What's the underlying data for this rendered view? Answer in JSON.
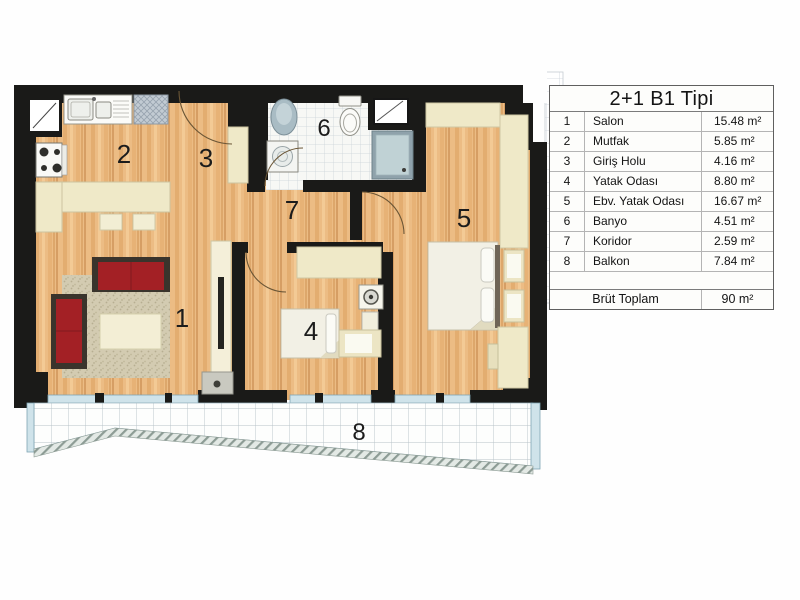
{
  "legend": {
    "title": "2+1 B1 Tipi",
    "rows": [
      {
        "num": "1",
        "name": "Salon",
        "area": "15.48 m²"
      },
      {
        "num": "2",
        "name": "Mutfak",
        "area": "5.85 m²"
      },
      {
        "num": "3",
        "name": "Giriş Holu",
        "area": "4.16 m²"
      },
      {
        "num": "4",
        "name": "Yatak Odası",
        "area": "8.80 m²"
      },
      {
        "num": "5",
        "name": "Ebv. Yatak Odası",
        "area": "16.67 m²"
      },
      {
        "num": "6",
        "name": "Banyo",
        "area": "4.51 m²"
      },
      {
        "num": "7",
        "name": "Koridor",
        "area": "2.59 m²"
      },
      {
        "num": "8",
        "name": "Balkon",
        "area": "7.84 m²"
      }
    ],
    "total_label": "Brüt Toplam",
    "total_value": "90 m²"
  },
  "plan": {
    "labels": [
      "1",
      "2",
      "3",
      "4",
      "5",
      "6",
      "7",
      "8"
    ],
    "colors": {
      "wall": "#1a1a18",
      "wood": "#ecbc84",
      "furniture_cream": "#efe9c8",
      "sofa_red": "#a32025",
      "balcony_glass": "#cfe3ea",
      "shower_blue": "#c0d2d5"
    }
  }
}
